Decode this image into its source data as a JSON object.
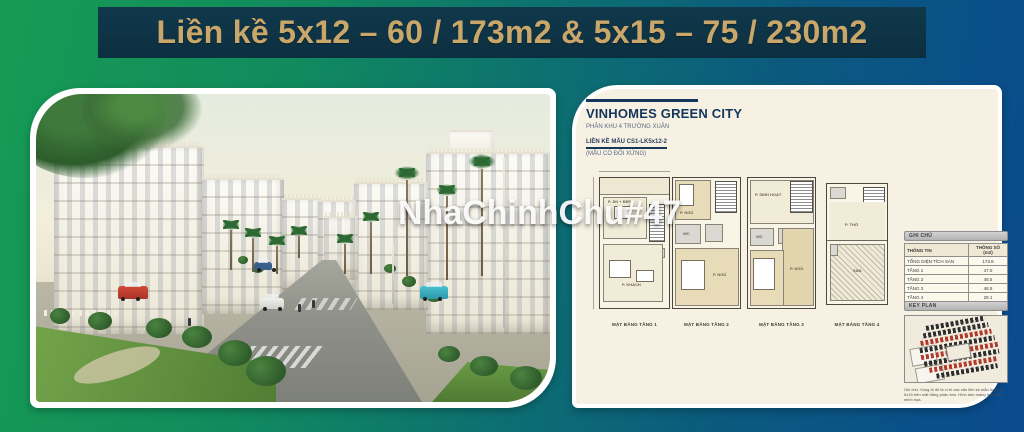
{
  "banner": {
    "title": "Liền kề 5x12 – 60 / 173m2 & 5x15 – 75 / 230m2",
    "bg_color": "#0c2f3f",
    "text_color": "#c9a76a"
  },
  "watermark": {
    "text": "NhaChinhChu#47"
  },
  "background": {
    "left_color": "#169b53",
    "mid_color": "#0d7170",
    "right_color": "#0a4a8e"
  },
  "right_card": {
    "header": {
      "title": "VINHOMES GREEN CITY",
      "subtitle": "PHÂN KHU 4 TRƯỜNG XUÂN",
      "model_line": "LIỀN KỀ MẪU CS1-LK5x12-2",
      "symmetry_note": "(MẪU CÓ ĐỐI XỨNG)"
    },
    "plans": [
      {
        "label": "MẶT BẰNG TẦNG 1",
        "rooms": {
          "top": "P. ĂN + BẾP",
          "bottom": "P. KHÁCH"
        }
      },
      {
        "label": "MẶT BẰNG TẦNG 2",
        "rooms": {
          "top": "P. NGỦ",
          "mid": "WC",
          "bottom": "P. NGỦ"
        }
      },
      {
        "label": "MẶT BẰNG TẦNG 3",
        "rooms": {
          "top": "P. SINH HOẠT",
          "mid": "WC",
          "bottom": "P. NGỦ"
        }
      },
      {
        "label": "MẶT BẰNG TẦNG 4",
        "rooms": {
          "top": "P. THỜ",
          "bottom": "SÂN"
        }
      }
    ],
    "notes_table": {
      "section_title": "GHI CHÚ",
      "col_info": "THÔNG TIN",
      "col_value": "THÔNG SỐ (m2)",
      "rows": [
        {
          "label": "TỔNG DIỆN TÍCH SÀN",
          "value": "173.8"
        },
        {
          "label": "TẦNG 1",
          "value": "47.0"
        },
        {
          "label": "TẦNG 2",
          "value": "48.5"
        },
        {
          "label": "TẦNG 3",
          "value": "48.5"
        },
        {
          "label": "TẦNG 4",
          "value": "28.1"
        }
      ]
    },
    "key_plan": {
      "section_title": "KEY PLAN",
      "highlight_color": "#b03a2e",
      "note": "Ghi chú: Vùng tô đỏ là vị trí các căn liền kề mẫu 5x12 & 5x15 trên mặt bằng phân khu. Hình ảnh mang tính chất minh họa."
    }
  }
}
